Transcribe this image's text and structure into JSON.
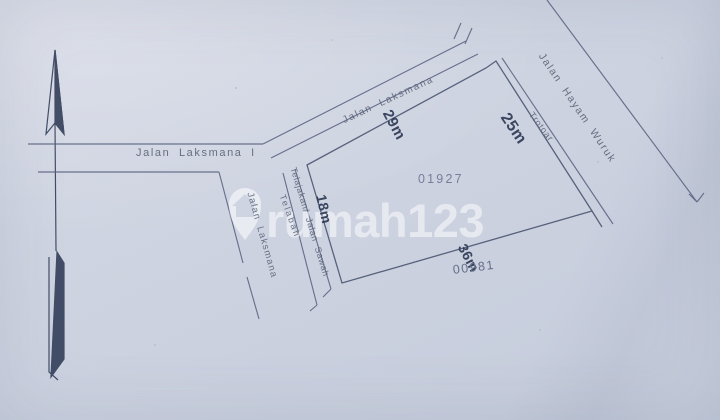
{
  "colors": {
    "paper": "#cbd1df",
    "ink": "#5a6380",
    "ink_dark": "#333e59",
    "dimension_ink": "#2e3a55",
    "parcel_number_ink": "#717b94",
    "watermark": "#ffffff"
  },
  "icons": {
    "north_arrow": "north-arrow-icon",
    "watermark_pin": "house-pin-icon"
  },
  "roads": {
    "laksmana_diagonal": "Jalan Laksmana",
    "laksmana_i": "Jalan Laksmana I",
    "laksmana_vertical": "Jalan Laksmana",
    "hayam_wuruk": "Jalan Hayam Wuruk",
    "trotoar": "Trotoar",
    "telajakan_jalan_sawah": "Telajakan/ Jalan Sawah",
    "telabah": "Telabah"
  },
  "parcel": {
    "number_top": "01927",
    "number_bottom": "00981",
    "dim_northwest": "29m",
    "dim_northeast": "25m",
    "dim_west": "18m",
    "dim_south": "36m"
  },
  "watermark": {
    "text": "rumah123"
  }
}
